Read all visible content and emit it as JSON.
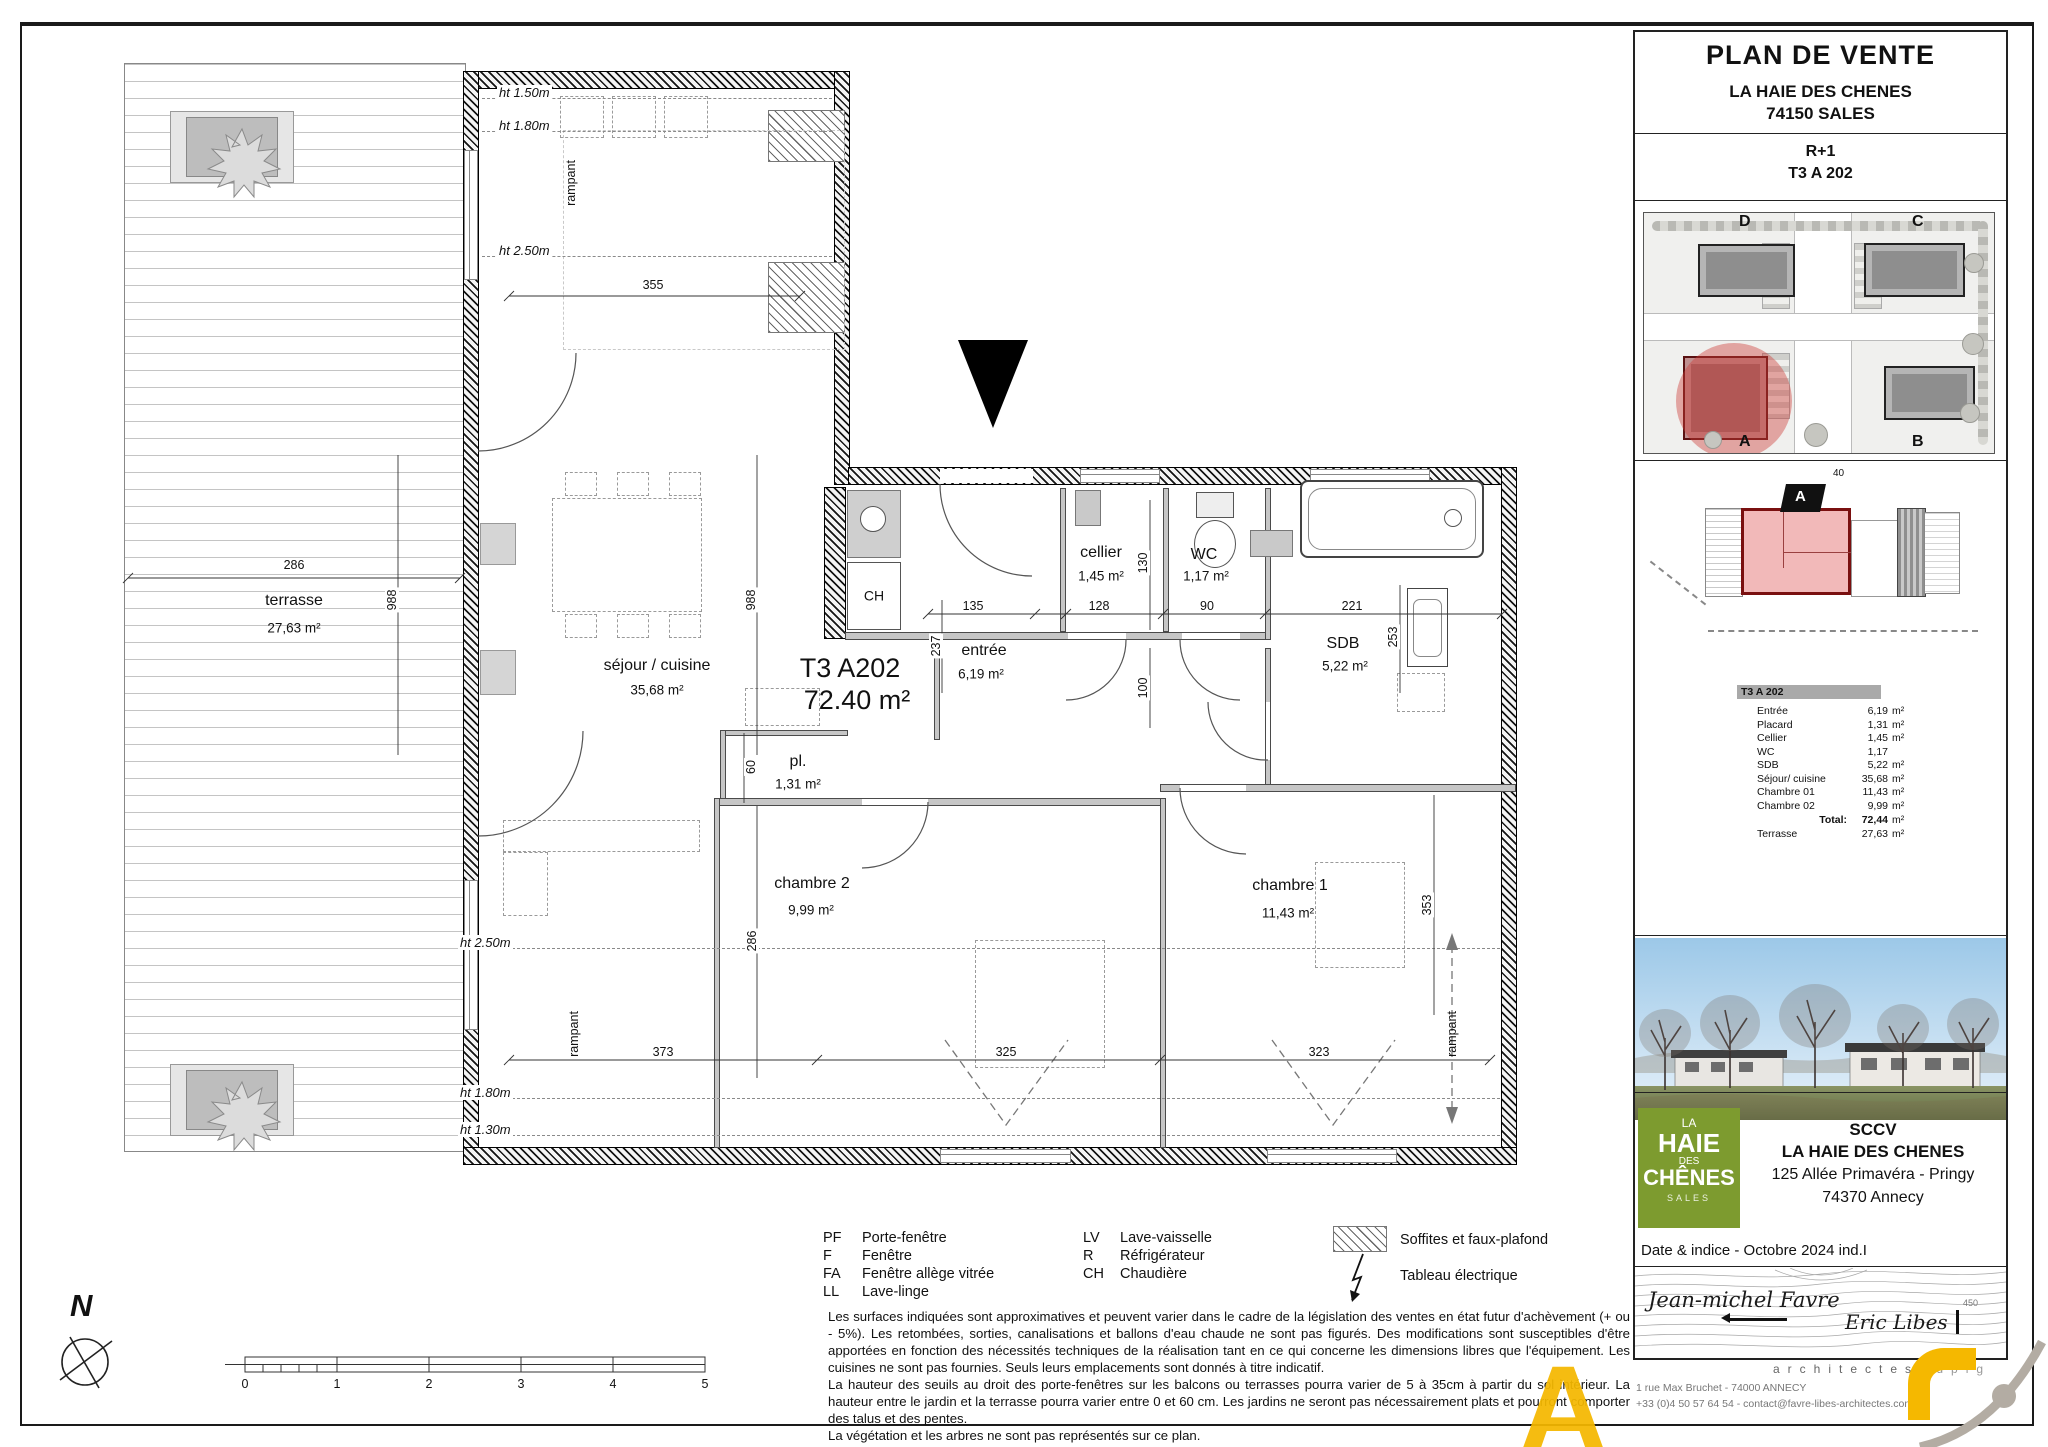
{
  "title_block": {
    "title": "PLAN DE VENTE",
    "project": "LA HAIE DES CHENES",
    "city": "74150 SALES",
    "level": "R+1",
    "unit": "T3 A 202"
  },
  "site_plan": {
    "labels": [
      "D",
      "C",
      "A",
      "B"
    ]
  },
  "key_plan": {
    "marker": "A",
    "dim_top": "40"
  },
  "area_table": {
    "header": "T3 A 202",
    "rows": [
      {
        "label": "Entrée",
        "value": "6,19",
        "unit": "m²"
      },
      {
        "label": "Placard",
        "value": "1,31",
        "unit": "m²"
      },
      {
        "label": "Cellier",
        "value": "1,45",
        "unit": "m²"
      },
      {
        "label": "WC",
        "value": "1,17",
        "unit": ""
      },
      {
        "label": "SDB",
        "value": "5,22",
        "unit": "m²"
      },
      {
        "label": "Séjour/ cuisine",
        "value": "35,68",
        "unit": "m²"
      },
      {
        "label": "Chambre 01",
        "value": "11,43",
        "unit": "m²"
      },
      {
        "label": "Chambre 02",
        "value": "9,99",
        "unit": "m²"
      }
    ],
    "total_label": "Total:",
    "total_value": "72,44",
    "total_unit": "m²",
    "terrace_label": "Terrasse",
    "terrace_value": "27,63",
    "terrace_unit": "m²"
  },
  "plan": {
    "unit_code": "T3 A202",
    "unit_area": "72.40 m²",
    "ch_label": "CH",
    "rooms": [
      {
        "name": "terrasse",
        "area": "27,63 m²"
      },
      {
        "name": "séjour / cuisine",
        "area": "35,68 m²"
      },
      {
        "name": "entrée",
        "area": "6,19 m²"
      },
      {
        "name": "cellier",
        "area": "1,45 m²"
      },
      {
        "name": "WC",
        "area": "1,17 m²"
      },
      {
        "name": "SDB",
        "area": "5,22 m²"
      },
      {
        "name": "pl.",
        "area": "1,31 m²"
      },
      {
        "name": "chambre 2",
        "area": "9,99 m²"
      },
      {
        "name": "chambre 1",
        "area": "11,43 m²"
      }
    ],
    "h_dims": [
      "286",
      "355",
      "135",
      "128",
      "90",
      "221",
      "373",
      "325",
      "323"
    ],
    "v_dims": [
      "988",
      "988",
      "237",
      "130",
      "100",
      "253",
      "60",
      "286",
      "353"
    ],
    "height_labels": [
      "ht 1.50m",
      "ht 1.80m",
      "ht 2.50m",
      "ht 2.50m",
      "ht 1.80m",
      "ht 1.30m"
    ],
    "rampant": "rampant",
    "north": "N",
    "scale_ticks": [
      "0",
      "1",
      "2",
      "3",
      "4",
      "5"
    ]
  },
  "legend": {
    "abbreviations": [
      {
        "abbr": "PF",
        "label": "Porte-fenêtre"
      },
      {
        "abbr": "F",
        "label": "Fenêtre"
      },
      {
        "abbr": "FA",
        "label": "Fenêtre allège vitrée"
      },
      {
        "abbr": "LL",
        "label": "Lave-linge"
      },
      {
        "abbr": "LV",
        "label": "Lave-vaisselle"
      },
      {
        "abbr": "R",
        "label": "Réfrigérateur"
      },
      {
        "abbr": "CH",
        "label": "Chaudière"
      }
    ],
    "symbols": [
      {
        "name": "soffit-hatch",
        "label": "Soffites et faux-plafond"
      },
      {
        "name": "electrical-panel",
        "label": "Tableau électrique"
      }
    ]
  },
  "disclaimer": {
    "p1": "Les surfaces indiquées sont approximatives et peuvent varier dans le cadre de la législation des ventes en état futur d'achèvement (+ ou - 5%). Les retombées, sorties, canalisations et ballons d'eau chaude ne sont pas figurés. Des modifications sont susceptibles d'être apportées en fonction des nécessités techniques de la réalisation tant en ce qui concerne les dimensions libres que l'équipement. Les cuisines ne sont pas fournies. Seuls leurs emplacements sont donnés à titre indicatif.",
    "p2": "La hauteur des seuils au droit des porte-fenêtres sur les balcons ou terrasses pourra varier de 5 à 35cm à partir du sol intérieur. La hauteur entre le jardin et la terrasse pourra varier entre 0 et 60 cm. Les jardins ne seront pas nécessairement plats et pourront comporter des talus et des pentes.",
    "p3": "La végétation et les arbres ne sont pas représentés sur ce plan."
  },
  "developer": {
    "logo_lines": [
      "LA",
      "HAIE",
      "DES",
      "CHÊNES",
      "SALES"
    ],
    "name1": "SCCV",
    "name2": "LA HAIE DES CHENES",
    "address1": "125 Allée Primavéra - Pringy",
    "address2": "74370 Annecy",
    "date_indice": "Date & indice - Octobre 2024 ind.I"
  },
  "architects": {
    "signature1": "Jean-michel Favre",
    "signature2": "Eric Libes",
    "title_row1": "architectes",
    "title_row2": "dplg",
    "elevation": "450",
    "address": "1 rue Max Bruchet - 74000 ANNECY",
    "contact": "+33 (0)4 50 57 64 54 - contact@favre-libes-architectes.com",
    "watermark": "A"
  },
  "colors": {
    "accent_yellow": "#F5B800",
    "logo_green": "#7D9B2F",
    "highlight_red": "#C0392B"
  }
}
